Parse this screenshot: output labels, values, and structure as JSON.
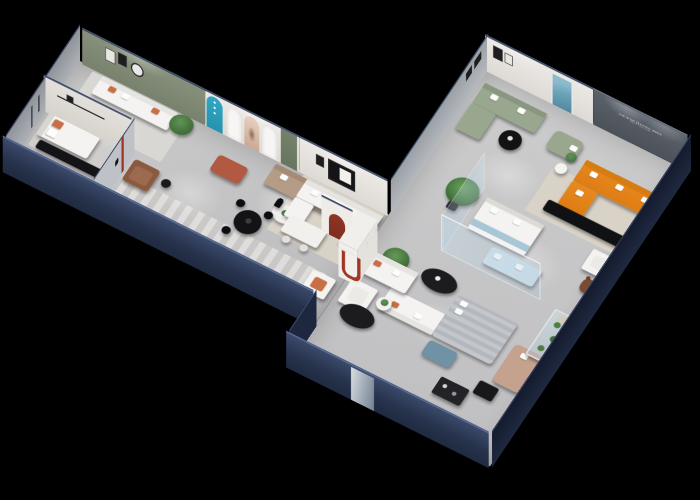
{
  "scene": {
    "type": "3d-isometric-floorplan-render",
    "setting": "cutaway dollhouse view of a furniture showroom apartment on a black background, dark navy exterior walls, gray floors with ceiling spotlights",
    "rooms": [
      {
        "name": "bedroom-display",
        "items": [
          "white bed with orange cushion",
          "black media console",
          "dark wall shelves"
        ]
      },
      {
        "name": "living-room-display",
        "items": [
          "sage green accent wall with two framed artworks and round mirror",
          "white sofa with orange pillows",
          "black desk and chair",
          "potted plant",
          "floor lamp",
          "gray rug"
        ]
      },
      {
        "name": "arch-gallery",
        "items": [
          "teal arched display panel with white motifs",
          "white arched niches with portrait poster",
          "green door panel",
          "terracotta ottoman",
          "tan sofa",
          "round white coffee table",
          "dark red arch niche",
          "brown leather armchair",
          "wall panel with red stripe logo"
        ]
      },
      {
        "name": "dining-lounge",
        "items": [
          "white corner sofa",
          "white dining table with chairs",
          "black round dining table with chairs",
          "black mannequin statue",
          "white column with red U arch",
          "white armchair with orange cushion",
          "black oval coffee tables",
          "striped runner rug",
          "large potted plant"
        ]
      },
      {
        "name": "main-living-showroom",
        "items": [
          "sage green sofa with chaise",
          "round black coffee table",
          "tall teal abstract painting",
          "sage chaise lounge",
          "dark feature wall with illuminated sign",
          "orange L-shaped sofa with white pillows",
          "black media console",
          "beige rug",
          "white armchair",
          "brown bear figure",
          "large potted plant"
        ]
      },
      {
        "name": "glass-bedroom-display",
        "items": [
          "glass partition walls",
          "white bed with blue throw",
          "light blue daybed"
        ]
      },
      {
        "name": "rest-area",
        "items": [
          "gray striped bed",
          "teal ottoman",
          "tan chaise lounge",
          "black side table",
          "black shelf unit",
          "white sofa and armchair with plant table",
          "glass display case with cacti",
          "bright mirror panel on front wall"
        ]
      }
    ]
  },
  "wall_sign": {
    "line1": "LIVE IN THE BEAUTIFUL WORLD",
    "line2": "ENJOY YOUR HOME"
  },
  "colors": {
    "bg": "#000000",
    "wall_navy": "#26314b",
    "wall_navy_dark": "#1d2740",
    "wall_cap": "#55668e",
    "floor": "#c6c6c7",
    "wall_white": "#ece9e5",
    "wall_sage": "#87907b",
    "wall_feature": "#4b5158",
    "wall_gray": "#aeb2b7",
    "teal_arch": "#2fa8c5",
    "teal_art": "#6ba2b8",
    "red_arch": "#8e3527",
    "red_u": "#a23524",
    "accent_orange": "#c96f45",
    "sofa_orange": "#e8891f",
    "sofa_white": "#f4f3f1",
    "sofa_sage": "#9aa78f",
    "sofa_tan": "#b59c86",
    "leather": "#8a5a40",
    "black_furniture": "#141416",
    "plant": "#4a7a42",
    "rug_beige": "#d8d2c7",
    "rug_gray": "#d9d7d3",
    "bed_blue": "#cfe0ea",
    "ottoman_teal": "#6f93a4",
    "bear_brown": "#7a4a33",
    "glass": "#bcd7e6"
  }
}
